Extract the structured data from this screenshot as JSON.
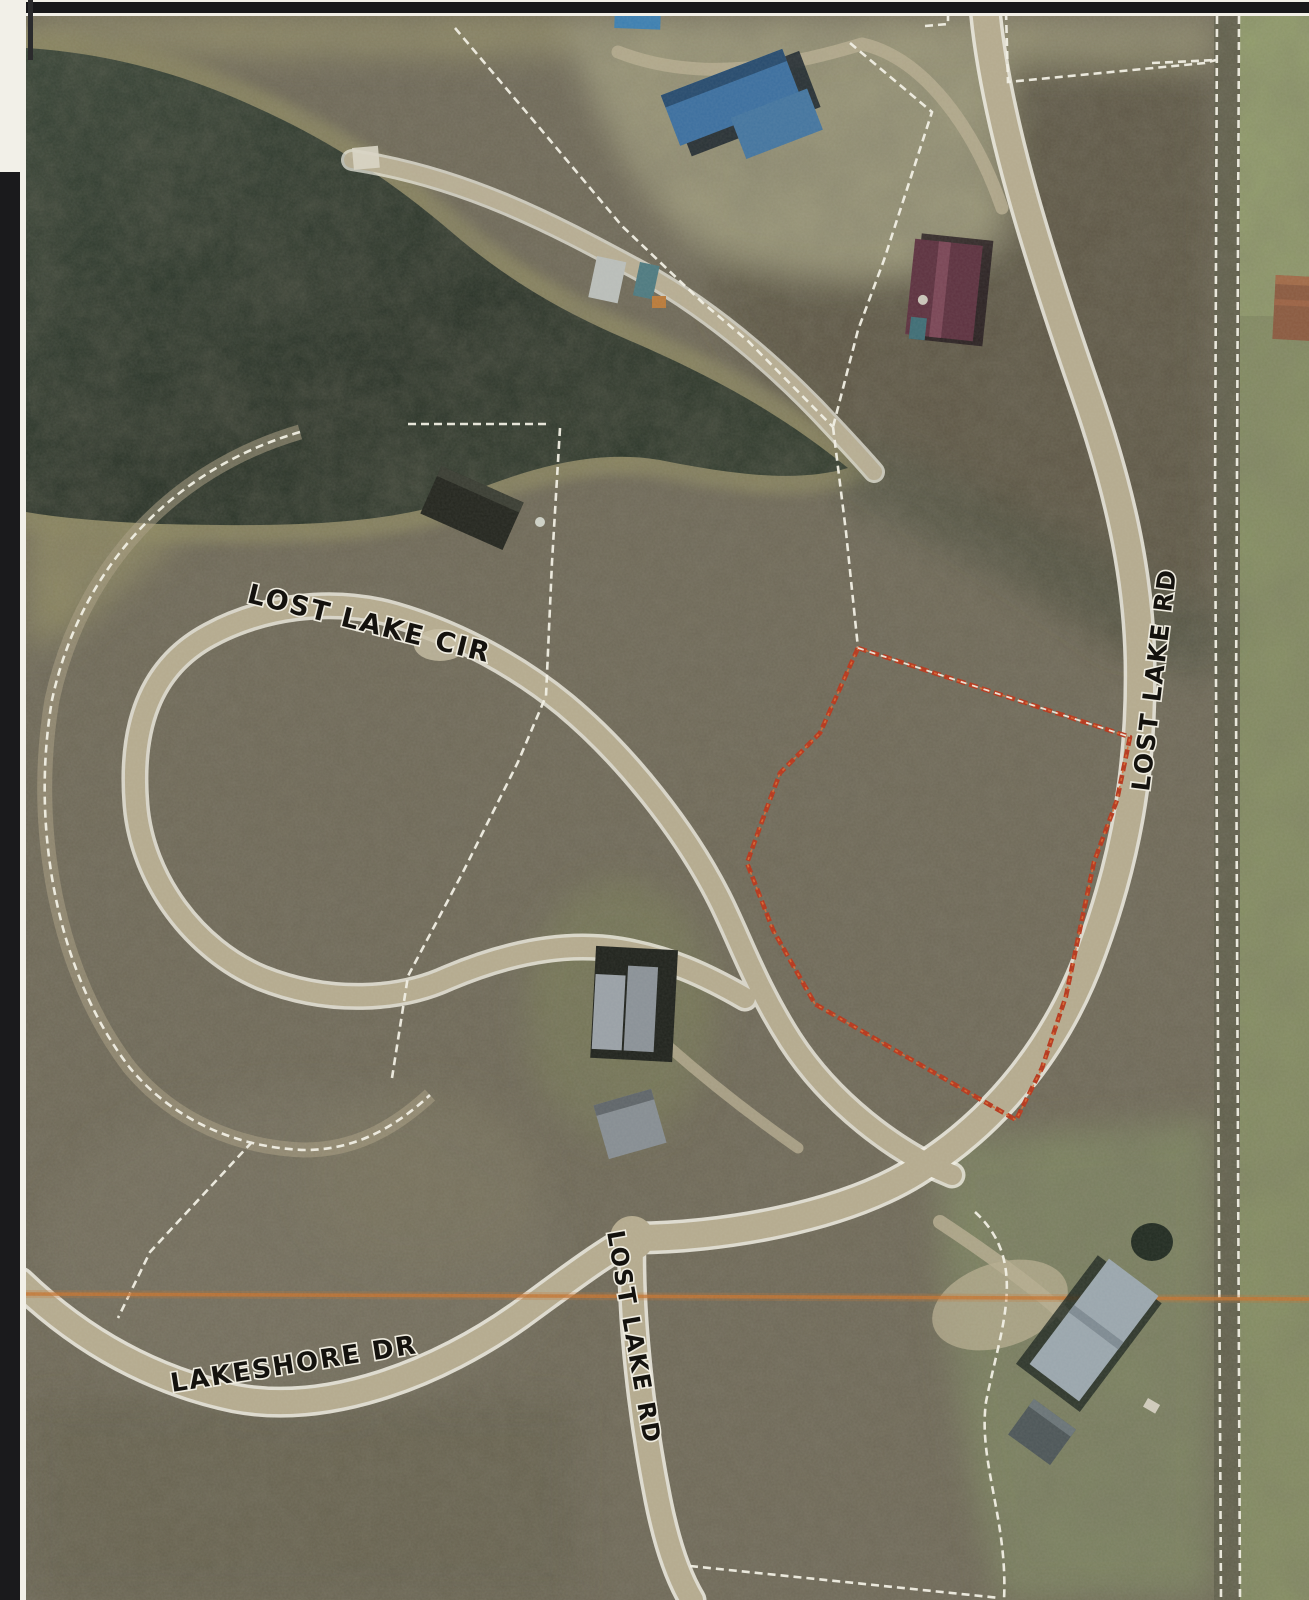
{
  "map": {
    "description": "Scanned color aerial GIS parcel map with lot boundaries",
    "road_labels": [
      {
        "text": "LOST LAKE CIR"
      },
      {
        "text": "LOST LAKE RD"
      },
      {
        "text": "LAKESHORE DR"
      },
      {
        "text": "LOST LAKE RD"
      }
    ],
    "highlight_parcel": {
      "outline_color": "#b5371c"
    },
    "section_line": {
      "color": "#c4732f"
    },
    "boundary_line_color": "#f1efe4"
  }
}
